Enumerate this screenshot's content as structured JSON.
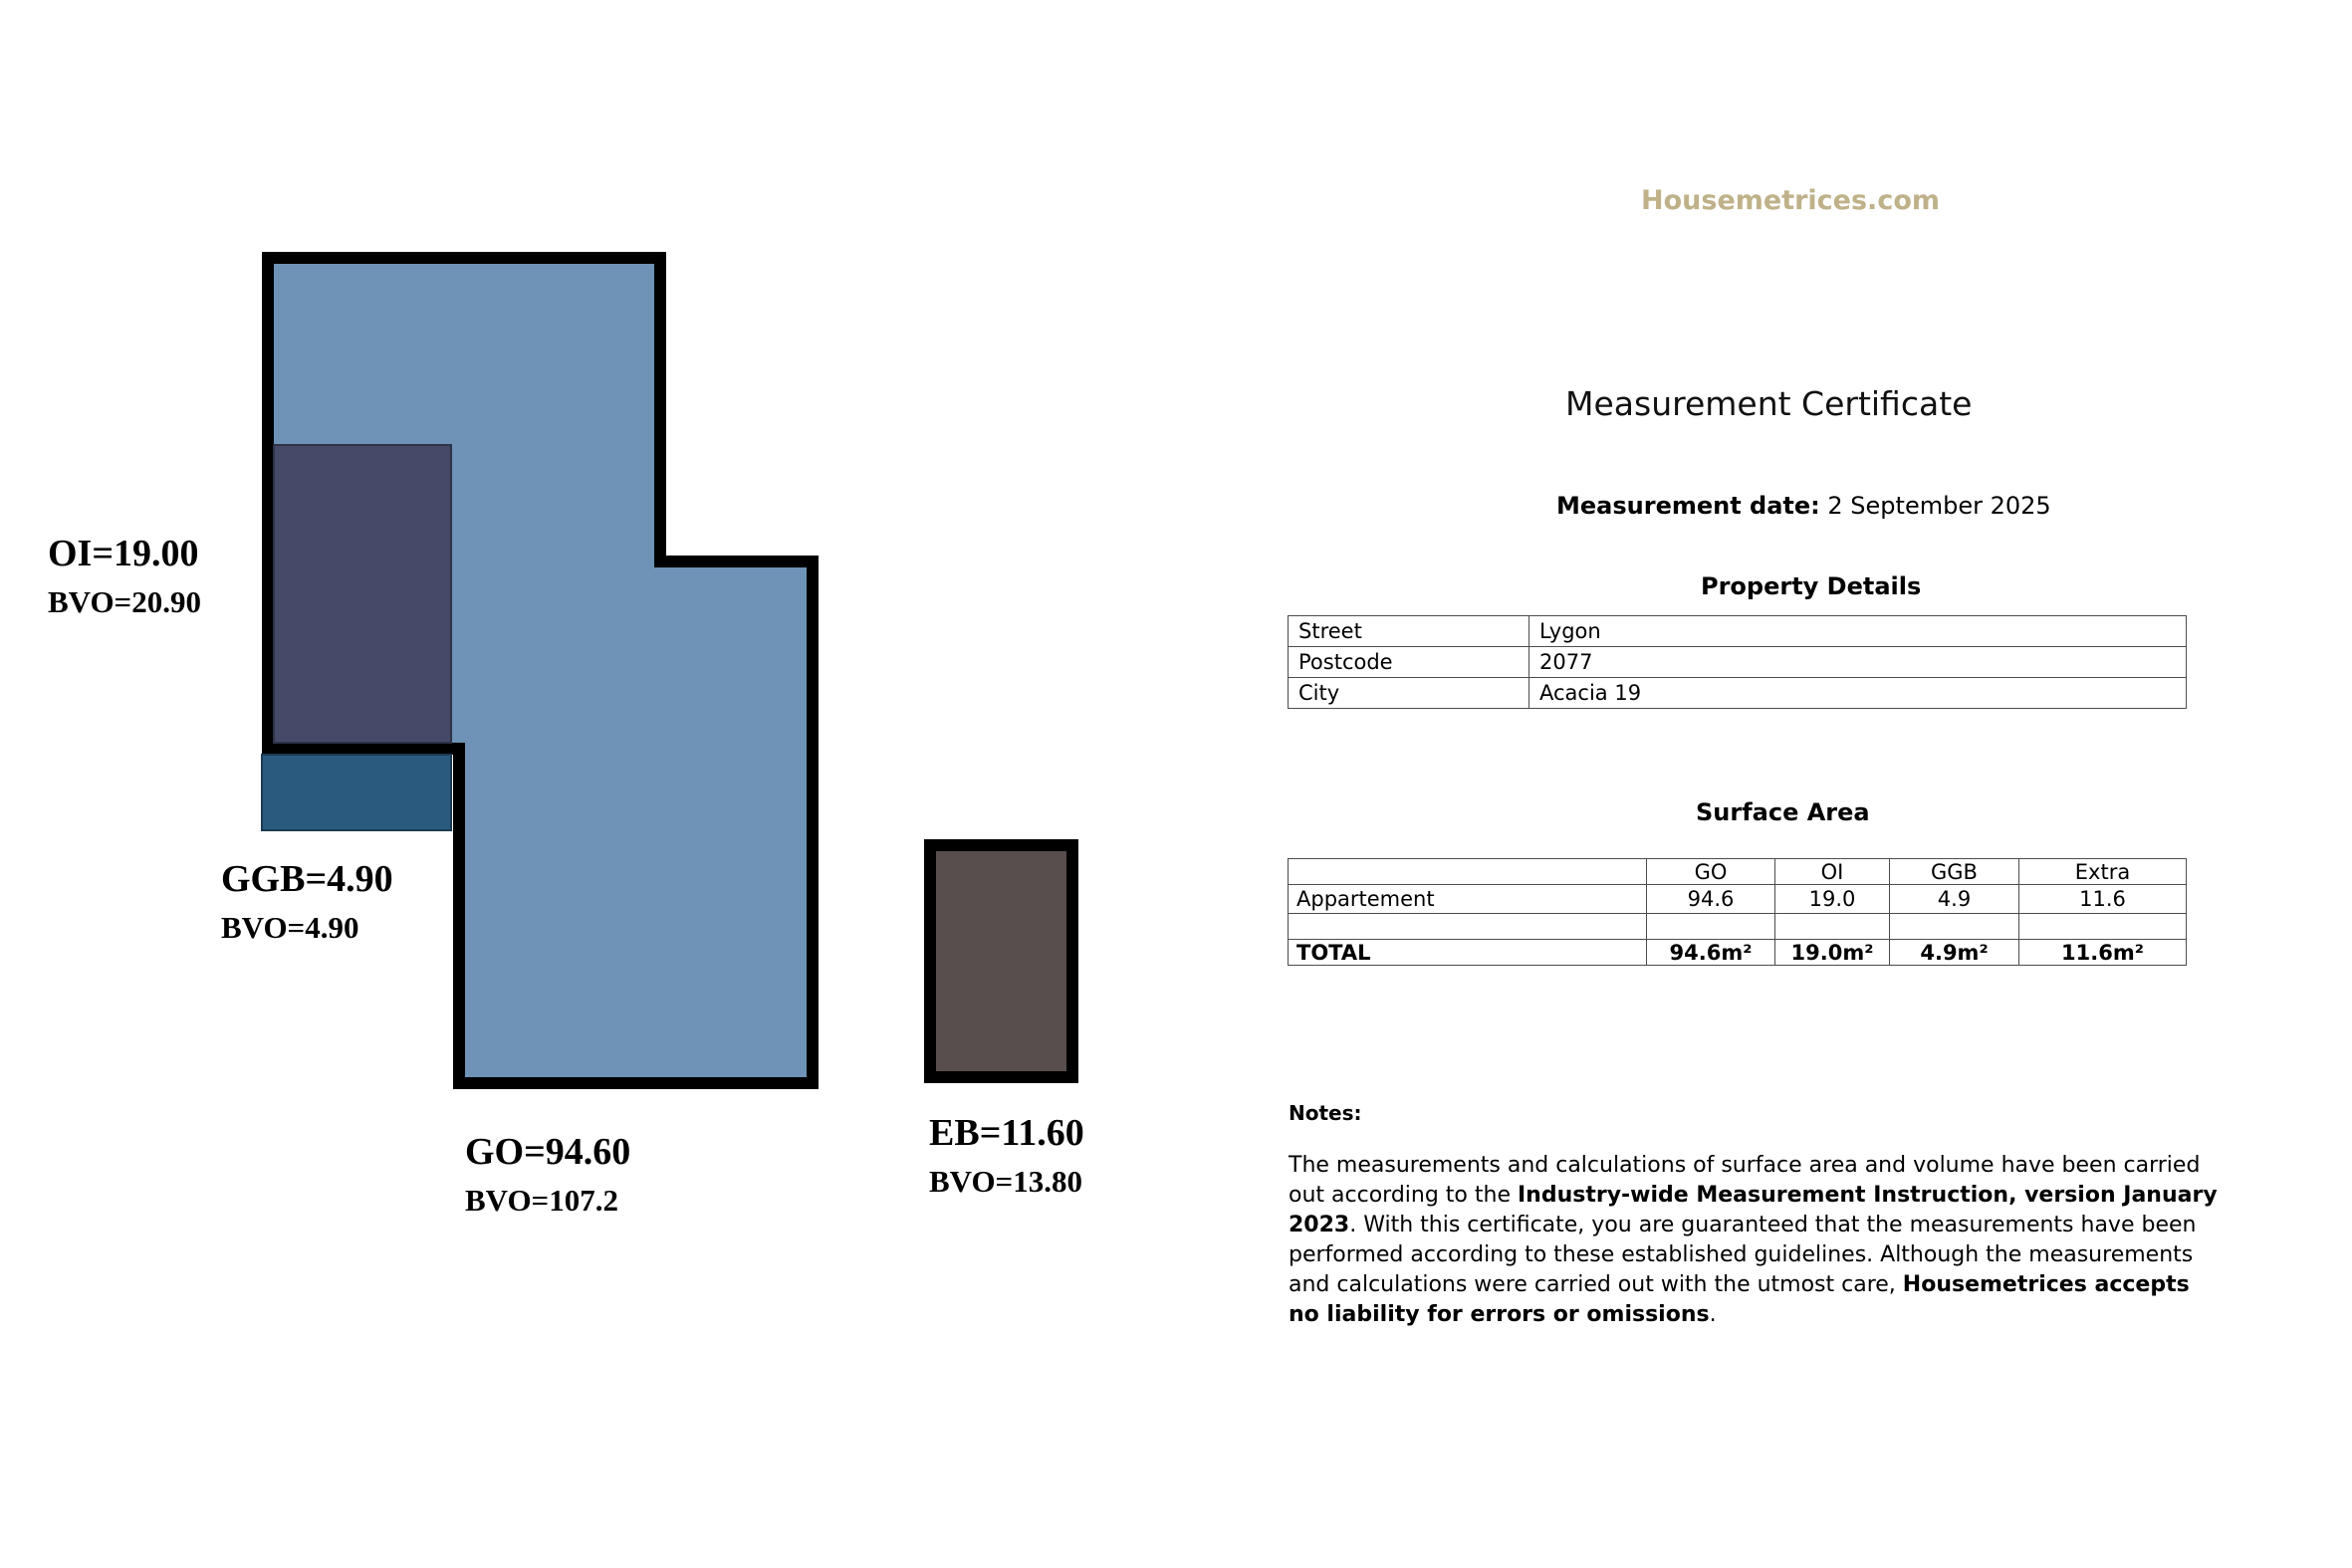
{
  "logo": {
    "text": "Housemetrices.com",
    "color": "#bfb189"
  },
  "certificate": {
    "title": "Measurement Certificate",
    "date_label": "Measurement date:",
    "date_value": "2 September 2025"
  },
  "property_details": {
    "heading": "Property Details",
    "rows": [
      [
        "Street",
        "Lygon"
      ],
      [
        "Postcode",
        "2077"
      ],
      [
        "City",
        "Acacia 19"
      ]
    ]
  },
  "surface_area": {
    "heading": "Surface Area",
    "columns": [
      "",
      "GO",
      "OI",
      "GGB",
      "Extra"
    ],
    "rows": [
      [
        "Appartement",
        "94.6",
        "19.0",
        "4.9",
        "11.6"
      ],
      [
        "",
        "",
        "",
        "",
        ""
      ],
      [
        "TOTAL",
        "94.6m²",
        "19.0m²",
        "4.9m²",
        "11.6m²"
      ]
    ]
  },
  "notes": {
    "heading": "Notes:",
    "seg1": "The measurements and calculations of surface area and volume have been carried out according to the ",
    "seg2": "Industry-wide Measurement Instruction, version January 2023",
    "seg3": ". With this certificate, you are guaranteed that the measurements have been performed according to these established guidelines. Although the measurements and calculations were carried out with the utmost care, ",
    "seg4": "Housemetrices accepts no liability for errors or omissions",
    "seg5": "."
  },
  "floor_plan": {
    "outline_color": "#000000",
    "units": [
      {
        "id": "GO",
        "area_label": "GO=94.60",
        "bvo_label": "BVO=107.2",
        "color": "#6e93b7"
      },
      {
        "id": "OI",
        "area_label": "OI=19.00",
        "bvo_label": "BVO=20.90",
        "color": "#454a69"
      },
      {
        "id": "GGB",
        "area_label": "GGB=4.90",
        "bvo_label": "BVO=4.90",
        "color": "#2a5a7e"
      },
      {
        "id": "EB",
        "area_label": "EB=11.60",
        "bvo_label": "BVO=13.80",
        "color": "#584e4e"
      }
    ]
  }
}
